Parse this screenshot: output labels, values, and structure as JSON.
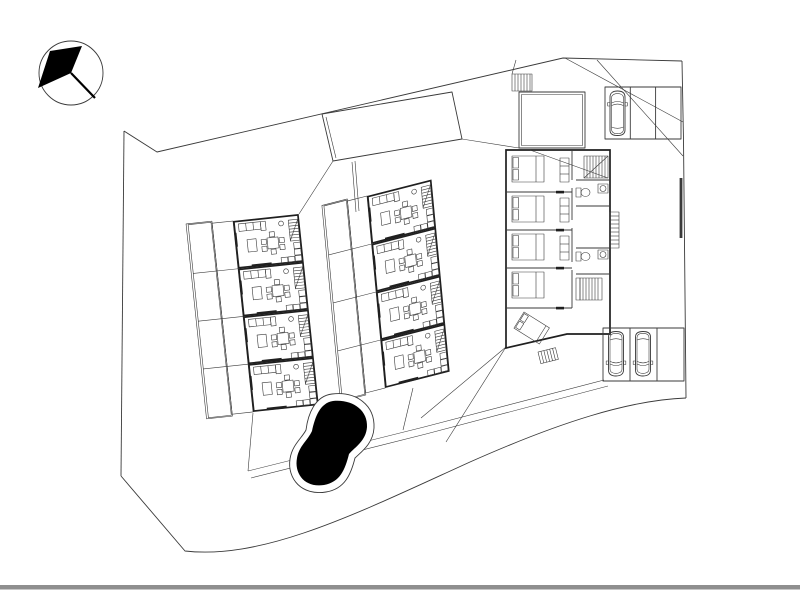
{
  "meta": {
    "title": "architectural site plan drawing",
    "sheet": {
      "background": "#ffffff",
      "bottom_edge_color": "#8f8f8f"
    }
  },
  "drawing": {
    "type": "site-plan",
    "line_color": "#3a3a3a",
    "wall_color": "#1f1f1f",
    "north_arrow": {
      "name": "north-arrow-compass",
      "direction": "pointing upper-left"
    },
    "site_boundary": {
      "name": "site-boundary",
      "shape": "irregular polygon with curved south edge"
    },
    "buildings": [
      {
        "id": "row-house-west",
        "label": "western row house, 4 units",
        "units": 4,
        "unit_contents": [
          "sofa",
          "coffee-table",
          "dining-table-with-6-chairs",
          "kitchen-counter",
          "staircase",
          "terrace",
          "garden-strip"
        ]
      },
      {
        "id": "row-house-center",
        "label": "central row house, 4 units",
        "units": 4,
        "unit_contents": [
          "sofa",
          "coffee-table",
          "dining-table-with-6-chairs",
          "kitchen-counter",
          "staircase",
          "terrace",
          "garden-strip"
        ]
      },
      {
        "id": "villa-east",
        "label": "eastern villa, 5 bedrooms",
        "bedrooms": 5,
        "contents": [
          "double-beds",
          "wardrobes",
          "bathroom-with-toilet-and-sink",
          "bathroom-2",
          "interior-stairs",
          "exterior-stairs",
          "courtyard",
          "angled-bed"
        ]
      }
    ],
    "landscape": {
      "pool": {
        "name": "swimming-pool",
        "fill": "#000000",
        "shape": "organic kidney shape with rim"
      },
      "lawn": {
        "name": "lawn-parallelogram",
        "shape": "tilted empty rectangle north of buildings"
      },
      "paths": {
        "name": "terrace-path",
        "style": "double line crossing behind pool"
      }
    },
    "parking": [
      {
        "id": "parking-north",
        "stalls": 3,
        "cars": 1
      },
      {
        "id": "parking-south",
        "stalls": 3,
        "cars": 2
      }
    ]
  }
}
